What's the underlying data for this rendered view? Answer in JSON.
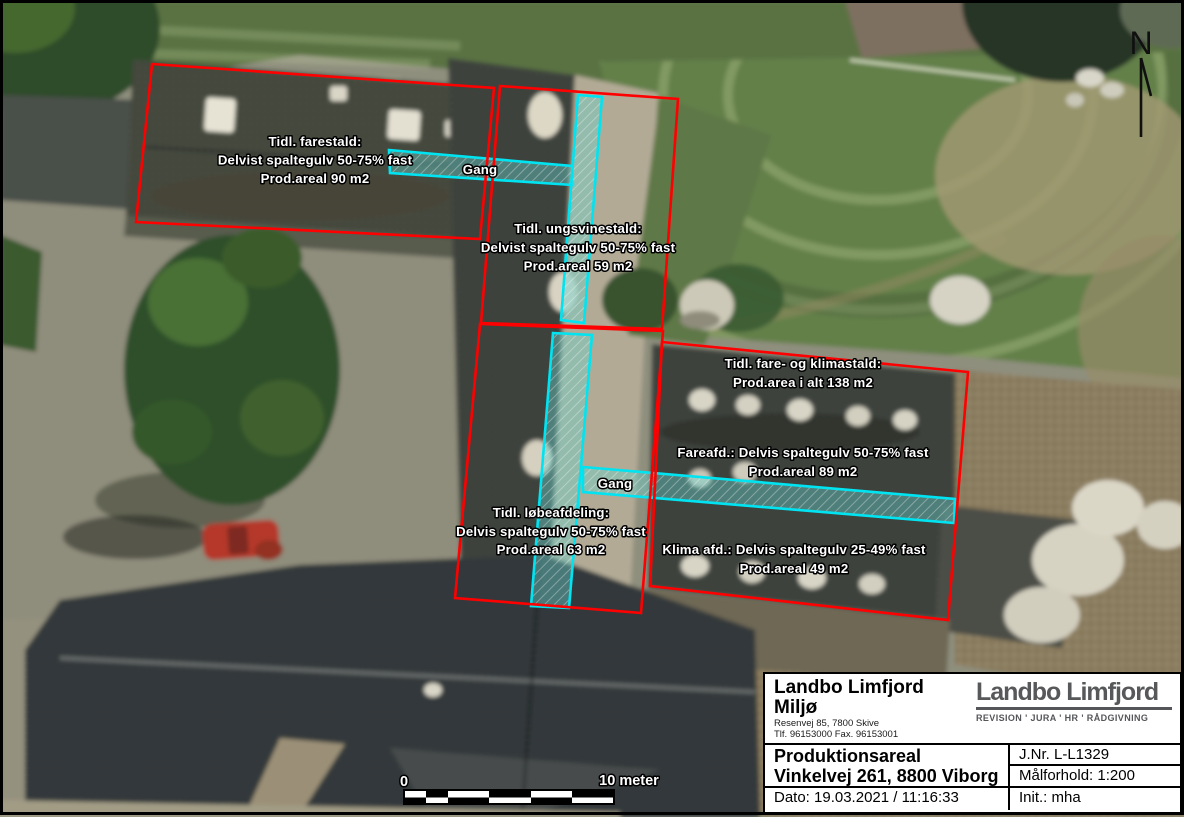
{
  "map": {
    "labels": {
      "farestald": {
        "line1": "Tidl. farestald:",
        "line2": "Delvist spaltegulv 50-75% fast",
        "line3": "Prod.areal 90 m2"
      },
      "gang1": "Gang",
      "ungsvinestald": {
        "line1": "Tidl. ungsvinestald:",
        "line2": "Delvist spaltegulv 50-75% fast",
        "line3": "Prod.areal 59 m2"
      },
      "fare_klimastald": {
        "line1": "Tidl. fare- og klimastald:",
        "line2": "Prod.area i alt 138 m2"
      },
      "fareafd": {
        "line1": "Fareafd.: Delvis spaltegulv 50-75% fast",
        "line2": "Prod.areal 89 m2"
      },
      "gang2": "Gang",
      "lobeafdeling": {
        "line1": "Tidl. løbeafdeling:",
        "line2": "Delvis spaltegulv 50-75% fast",
        "line3": "Prod.areal 63 m2"
      },
      "klima_afd": {
        "line1": "Klima afd.: Delvis spaltegulv 25-49% fast",
        "line2": "Prod.areal 49 m2"
      }
    },
    "north_label": "N",
    "scale_bar": {
      "start_label": "0",
      "end_label": "10 meter"
    },
    "colors": {
      "area_outline": "#ff0000",
      "gang_outline": "#00e4f2"
    }
  },
  "title_block": {
    "company_line1": "Landbo Limfjord",
    "company_line2": "Miljø",
    "address_line1": "Resenvej 85, 7800 Skive",
    "address_line2": "Tlf. 96153000 Fax. 96153001",
    "logo_text": "Landbo Limfjord",
    "logo_tagline": "REVISION ' JURA ' HR ' RÅDGIVNING",
    "project_title": "Produktionsareal",
    "project_address": "Vinkelvej 261, 8800 Viborg",
    "date_line": "Dato: 19.03.2021 / 11:16:33",
    "journal_no": "J.Nr. L-L1329",
    "scale_ratio": "Målforhold: 1:200",
    "initials": "Init.: mha"
  }
}
